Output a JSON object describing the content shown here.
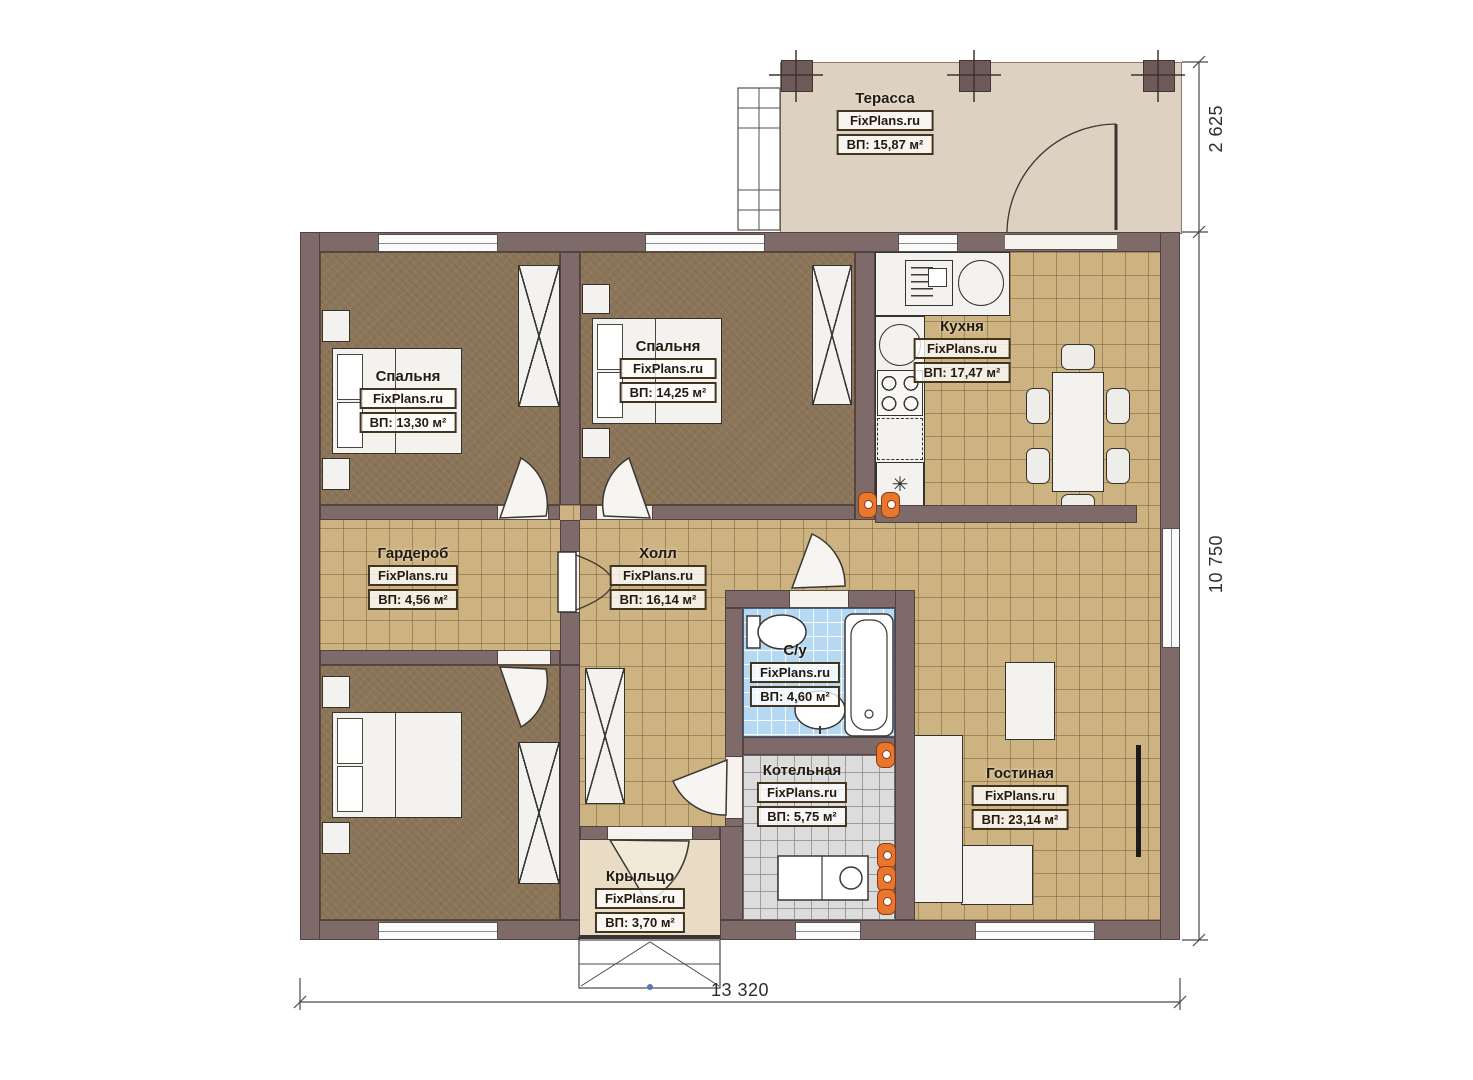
{
  "watermark": "FixPlans.ru",
  "rooms": [
    {
      "id": "terrace",
      "name": "Терасса",
      "area": "ВП: 15,87 м²"
    },
    {
      "id": "bedroom-1",
      "name": "Спальня",
      "area": "ВП: 13,30 м²"
    },
    {
      "id": "bedroom-2",
      "name": "Спальня",
      "area": "ВП: 14,25 м²"
    },
    {
      "id": "kitchen",
      "name": "Кухня",
      "area": "ВП: 17,47 м²"
    },
    {
      "id": "wardrobe",
      "name": "Гардероб",
      "area": "ВП: 4,56 м²"
    },
    {
      "id": "hall",
      "name": "Холл",
      "area": "ВП: 16,14 м²"
    },
    {
      "id": "bathroom",
      "name": "С/у",
      "area": "ВП: 4,60 м²"
    },
    {
      "id": "boiler",
      "name": "Котельная",
      "area": "ВП: 5,75 м²"
    },
    {
      "id": "living",
      "name": "Гостиная",
      "area": "ВП: 23,14 м²"
    },
    {
      "id": "porch",
      "name": "Крыльцо",
      "area": "ВП: 3,70 м²"
    }
  ],
  "dimensions": {
    "terrace_height": "2 625",
    "house_height": "10 750",
    "house_width": "13 320"
  },
  "icons": {
    "fridge": "✳"
  },
  "colors": {
    "wall": "#7d6a69",
    "tile": "#cdb382",
    "bedroom_floor": "#8c765a",
    "terrace": "#ddd1c1",
    "porch": "#e9dcc4",
    "bath_tile": "#b5d9f2",
    "boiler_tile": "#dcdcdc",
    "radiator": "#e8762c"
  }
}
